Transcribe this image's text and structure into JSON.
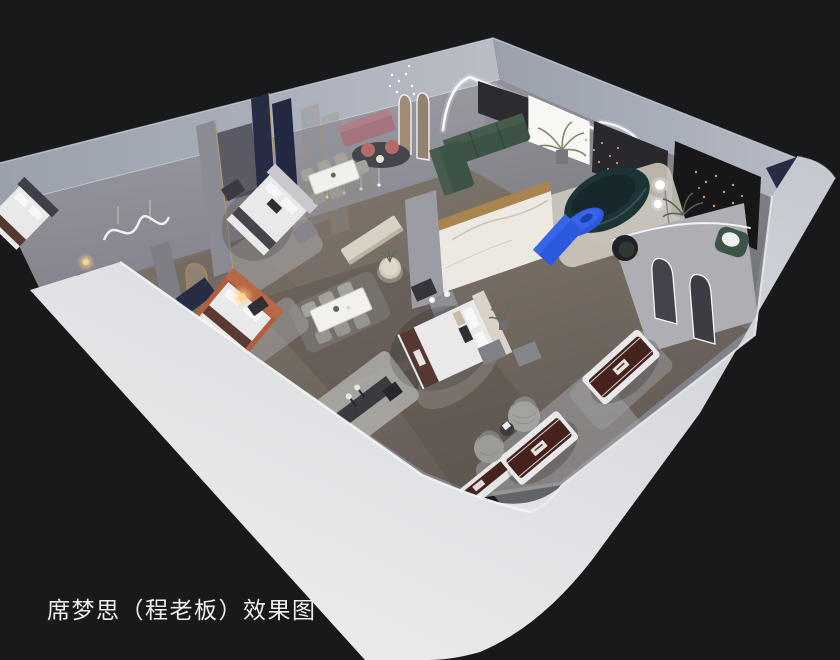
{
  "caption": {
    "text": "席梦思（程老板）效果图"
  },
  "palette": {
    "background": "#18191b",
    "wall_top": "#a9aeb8",
    "wall_face_light": "#ecedef",
    "wall_face_mid": "#c6cad1",
    "wall_interior": "#95959d",
    "wall_interior_dark": "#77767e",
    "floor": "#7d746b",
    "floor_dark": "#5d564f",
    "rug_light": "#b8b9bc",
    "rug_dark": "#45454c",
    "marble": "#ece9e3",
    "gold": "#a9844f",
    "navy_panel": "#272c45",
    "green_sofa": "#3d5345",
    "teal_sofa": "#1d3437",
    "blue_accent": "#2c58dd",
    "mattress_brown": "#46221d",
    "bed_white": "#e9e9ea",
    "pink_sofa": "#a5737c",
    "orange_bed": "#b05e3e",
    "lamp_glow": "#f2bc66",
    "led_white": "#ffffff",
    "caption_color": "#ededee"
  },
  "scene": {
    "type": "3d-isometric-cutaway-rendering",
    "subject": "mattress showroom interior",
    "items": [
      "bed-displays",
      "mattress-displays",
      "dining-sets",
      "green-sectional-sofa",
      "curved-teal-sofa",
      "blue-coffee-table",
      "arched-mirrors",
      "led-cove-lighting",
      "area-rugs",
      "pendant-lights",
      "floor-plants",
      "fluffy-armchairs"
    ]
  }
}
